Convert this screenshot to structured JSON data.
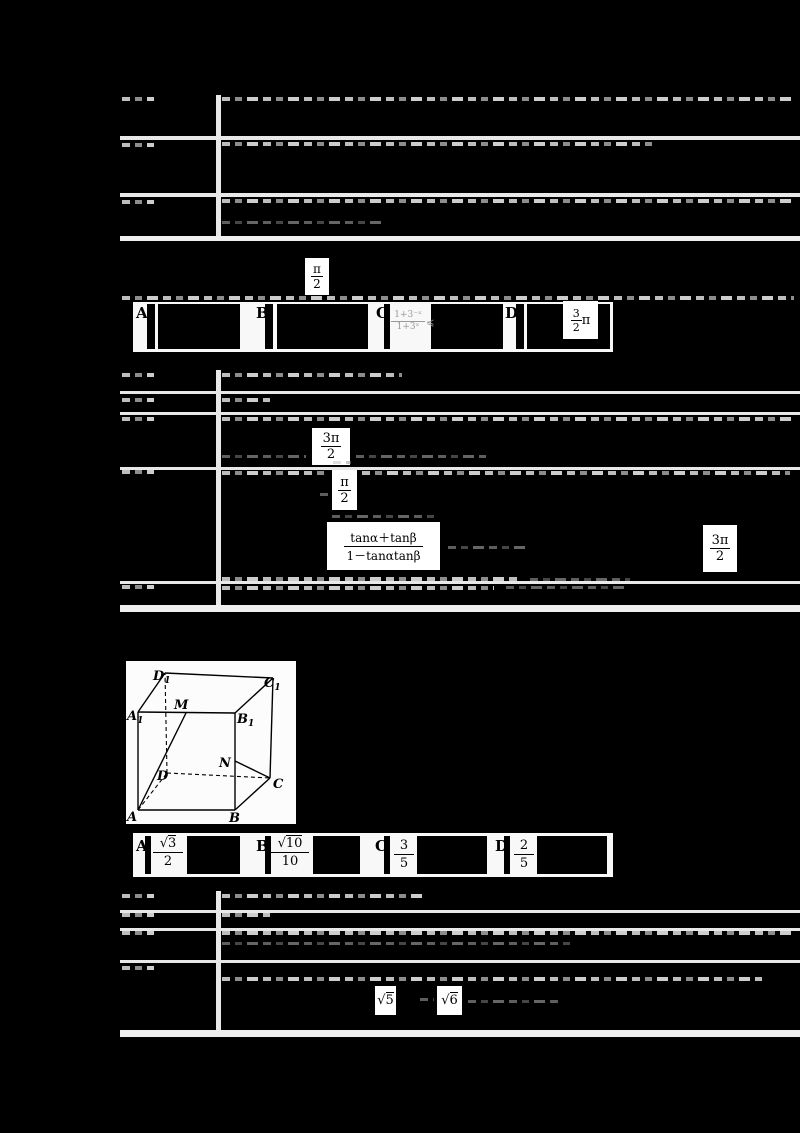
{
  "colors": {
    "page_bg": "#000000",
    "table_gap": "#e8e8e8",
    "formula_bg": "#ffffff",
    "option_strip_bg": "#f8f8f8",
    "ink": "#000000",
    "ghost_gray": "#bdbdbd"
  },
  "glyphs": {
    "sqrt": "√",
    "pi": "π"
  },
  "table1": {
    "rows": [
      {
        "label": "分析",
        "text": "根据函数的奇偶性和单调性，逐一判断各个选项中的函数是否满足条件，从而得出结论．"
      },
      {
        "label": "解答",
        "text": "解：由函数的图象与性质可知，该函数为偶函数，且在（0，＋∞）上单调递增，满足条件，而其余选项均不满足条件，故选：Ｂ．"
      },
      {
        "label": "点评",
        "text": "本题主要考查函数的奇偶性和单调性的判断，属于基础题．"
      }
    ]
  },
  "question2": {
    "text": "2．已知角α、β，且α＋β＝，则下列各式的值等于tan（α＋β）的是（　　）",
    "inline_formula": {
      "num": "π",
      "den": "2"
    },
    "options": [
      {
        "label": "A"
      },
      {
        "label": "B"
      },
      {
        "label": "C",
        "ghost_formula": {
          "num": "1+3⁻ˣ",
          "den": "1+3ˣ",
          "rel": "≼"
        }
      },
      {
        "label": "D",
        "formula": {
          "num": "3",
          "den": "2",
          "pi": "π"
        }
      }
    ]
  },
  "table2": {
    "rows": [
      {
        "label": "考点",
        "text": "两角和与差的正切函数；诱导公式的作用．"
      },
      {
        "label": "专题",
        "text": "计算题．"
      },
      {
        "label": "分析",
        "text": "由条件利用诱导公式可得所求式子即为 tan 的值，再利用两角和的正切公式求得结果．",
        "formula_3pi2": {
          "num": "3π",
          "den": "2"
        }
      },
      {
        "label": "解答",
        "text": "解：∵α＋β＝，∴tan（α＋β）＝，即原式＝tan，故选：Ｄ．",
        "formula_pi2": {
          "num": "π",
          "den": "2"
        },
        "formula_tan": {
          "num": "tanα＋tanβ",
          "den": "1－tanαtanβ"
        },
        "formula_3pi2": {
          "num": "3π",
          "den": "2"
        }
      },
      {
        "label": "点评",
        "text": "本题主要考查诱导公式、两角和的正切公式的应用，属于基础题．"
      }
    ]
  },
  "question3": {
    "text": "3．如图，在正方体ABCD－A1B1C1D1中，M、N分别是棱A1B1、B1B的中点，则异面直线AM与CN所成角的余弦值为（　　）",
    "options": [
      {
        "label": "A",
        "formula": {
          "rad": "3",
          "den": "2"
        }
      },
      {
        "label": "B",
        "formula": {
          "rad": "10",
          "den": "10"
        }
      },
      {
        "label": "C",
        "formula": {
          "num": "3",
          "den": "5"
        }
      },
      {
        "label": "D",
        "formula": {
          "num": "2",
          "den": "5"
        }
      }
    ]
  },
  "cube": {
    "labels": {
      "A": {
        "base": "A"
      },
      "B": {
        "base": "B"
      },
      "C": {
        "base": "C"
      },
      "D": {
        "base": "D"
      },
      "A1": {
        "base": "A",
        "sub": "1"
      },
      "B1": {
        "base": "B",
        "sub": "1"
      },
      "C1": {
        "base": "C",
        "sub": "1"
      },
      "D1": {
        "base": "D",
        "sub": "1"
      },
      "M": {
        "base": "M"
      },
      "N": {
        "base": "N"
      }
    }
  },
  "table3": {
    "rows": [
      {
        "label": "考点",
        "text": "异面直线及其所成的角．"
      },
      {
        "label": "专题",
        "text": "计算题．"
      },
      {
        "label": "分析",
        "text": "取AB的中点E，连接CE、NE，则∠ENC（或其补角）即为异面直线AM与CN所成的角，解三角形即可得到结论．"
      },
      {
        "label": "解答",
        "text": "解：设正方体的棱长为2，取AB的中点E，连接CE、NE，则EN＝，CN＝，在△ENC中利用余弦定理求得所成角的余弦值，故选：Ｄ．",
        "formula_sqrt5": {
          "rad": "5"
        },
        "formula_sqrt6": {
          "rad": "6"
        }
      }
    ]
  }
}
